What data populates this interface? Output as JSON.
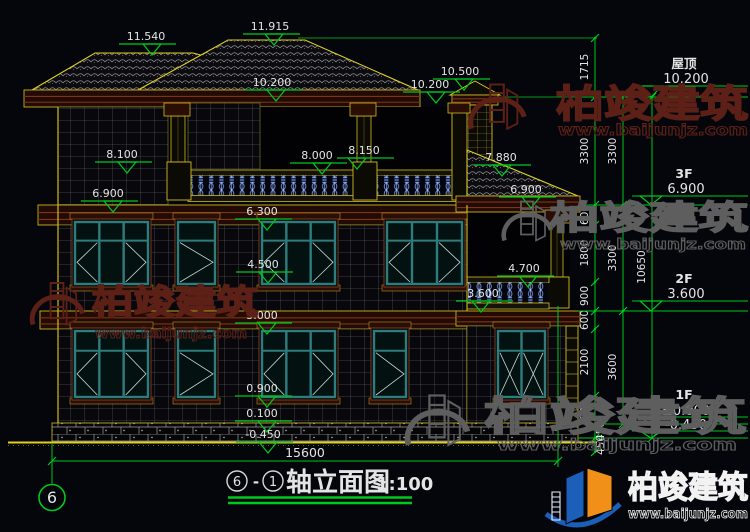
{
  "page": {
    "bg": "#05060b"
  },
  "colors": {
    "dim_green": "#00c81e",
    "cad_yellow": "#d4c41c",
    "text_white": "#e4e4e4",
    "window_teal": "#2e7c7c",
    "band_maroon": "#7c3418",
    "baluster_blue": "#6f94e8",
    "wm_red": "#5c2017",
    "wm_gray": "#5e5e5e",
    "logo_blue": "#1c5fb8",
    "logo_orange": "#f09018"
  },
  "brand": {
    "name": "柏竣建筑",
    "url": "www.baijunjz.com"
  },
  "title_block": {
    "bubble_a": "6",
    "dash": "-",
    "bubble_b": "1",
    "text": "轴立面图",
    "scale": "1:100"
  },
  "axis": {
    "label": "6"
  },
  "bottom_dimension": {
    "value": "15600"
  },
  "elevation_marks": [
    {
      "v": "11.540",
      "x": 146,
      "y": 36,
      "cx": 152
    },
    {
      "v": "11.915",
      "x": 270,
      "y": 26,
      "cx": 274
    },
    {
      "v": "10.500",
      "x": 460,
      "y": 71,
      "cx": 464
    },
    {
      "v": "10.200",
      "x": 430,
      "y": 84,
      "cx": 436
    },
    {
      "v": "10.200",
      "x": 272,
      "y": 82,
      "cx": 276
    },
    {
      "v": "8.100",
      "x": 122,
      "y": 154,
      "cx": 127
    },
    {
      "v": "8.000",
      "x": 317,
      "y": 155,
      "cx": 322
    },
    {
      "v": "8.150",
      "x": 364,
      "y": 150,
      "cx": 357
    },
    {
      "v": "7.880",
      "x": 501,
      "y": 157,
      "cx": 502
    },
    {
      "v": "6.900",
      "x": 108,
      "y": 193,
      "cx": 113
    },
    {
      "v": "6.900",
      "x": 526,
      "y": 189,
      "cx": 531
    },
    {
      "v": "6.300",
      "x": 262,
      "y": 211,
      "cx": 267
    },
    {
      "v": "4.500",
      "x": 263,
      "y": 264,
      "cx": 268
    },
    {
      "v": "4.700",
      "x": 524,
      "y": 268,
      "cx": 528
    },
    {
      "v": "3.600",
      "x": 483,
      "y": 293,
      "cx": 481
    },
    {
      "v": "3.000",
      "x": 262,
      "y": 315,
      "cx": 267
    },
    {
      "v": "0.900",
      "x": 262,
      "y": 388,
      "cx": 267
    },
    {
      "v": "0.100",
      "x": 262,
      "y": 413,
      "cx": 267
    },
    {
      "v": "-0.450",
      "x": 263,
      "y": 434,
      "cx": 268
    }
  ],
  "dim_chains": [
    {
      "x": 595,
      "ticks": [
        38,
        97,
        205,
        225,
        282,
        311,
        329,
        396,
        424,
        438,
        452
      ],
      "labels": [
        {
          "t": "1715",
          "y": 67
        },
        {
          "t": "3300",
          "y": 151
        },
        {
          "t": "600",
          "y": 215
        },
        {
          "t": "1800",
          "y": 253
        },
        {
          "t": "900",
          "y": 296
        },
        {
          "t": "600",
          "y": 320
        },
        {
          "t": "2100",
          "y": 362
        },
        {
          "t": "900",
          "y": 410
        },
        {
          "t": "450",
          "y": 431,
          "dx": 16
        },
        {
          "t": "450",
          "y": 445,
          "dx": 16
        }
      ]
    },
    {
      "x": 623,
      "ticks": [
        97,
        205,
        311,
        424
      ],
      "labels": [
        {
          "t": "3300",
          "y": 151
        },
        {
          "t": "3300",
          "y": 258
        },
        {
          "t": "3600",
          "y": 367
        }
      ]
    },
    {
      "x": 652,
      "ticks": [
        97,
        438
      ],
      "labels": [
        {
          "t": "10650",
          "y": 267
        }
      ]
    }
  ],
  "floor_levels": [
    {
      "name": "屋顶",
      "value": "10.200",
      "ny": 63,
      "vy": 78,
      "uy": 86,
      "ly": 97
    },
    {
      "name": "3F",
      "value": "6.900",
      "ny": 173,
      "vy": 188,
      "uy": 196,
      "ly": 205
    },
    {
      "name": "2F",
      "value": "3.600",
      "ny": 278,
      "vy": 293,
      "uy": 301,
      "ly": 311
    },
    {
      "name": "1F",
      "value": "±0.000",
      "ny": 394,
      "vy": 410,
      "uy": 417,
      "ly": 424
    },
    {
      "name": "",
      "value": "-0.450",
      "ny": 0,
      "vy": 424,
      "uy": 431,
      "ly": 438
    }
  ],
  "watermarks": [
    {
      "style": "red",
      "gx": 497,
      "gy": 110,
      "gs": 0.85,
      "tx": 556,
      "ty": 117,
      "tl": 192,
      "fs": 38,
      "ux": 558,
      "uy": 135,
      "ul": 190,
      "ufs": 15
    },
    {
      "style": "red",
      "gx": 57,
      "gy": 307,
      "gs": 0.8,
      "tx": 92,
      "ty": 314,
      "tl": 166,
      "fs": 34,
      "ux": 95,
      "uy": 338,
      "ul": 152,
      "ufs": 14
    },
    {
      "style": "gray",
      "gx": 527,
      "gy": 224,
      "gs": 0.75,
      "tx": 550,
      "ty": 229,
      "tl": 198,
      "fs": 33,
      "ux": 560,
      "uy": 249,
      "ul": 186,
      "ufs": 14
    },
    {
      "style": "gray",
      "gx": 437,
      "gy": 424,
      "gs": 0.95,
      "tx": 484,
      "ty": 430,
      "tl": 262,
      "fs": 40,
      "ux": 497,
      "uy": 450,
      "ul": 240,
      "ufs": 16
    }
  ]
}
